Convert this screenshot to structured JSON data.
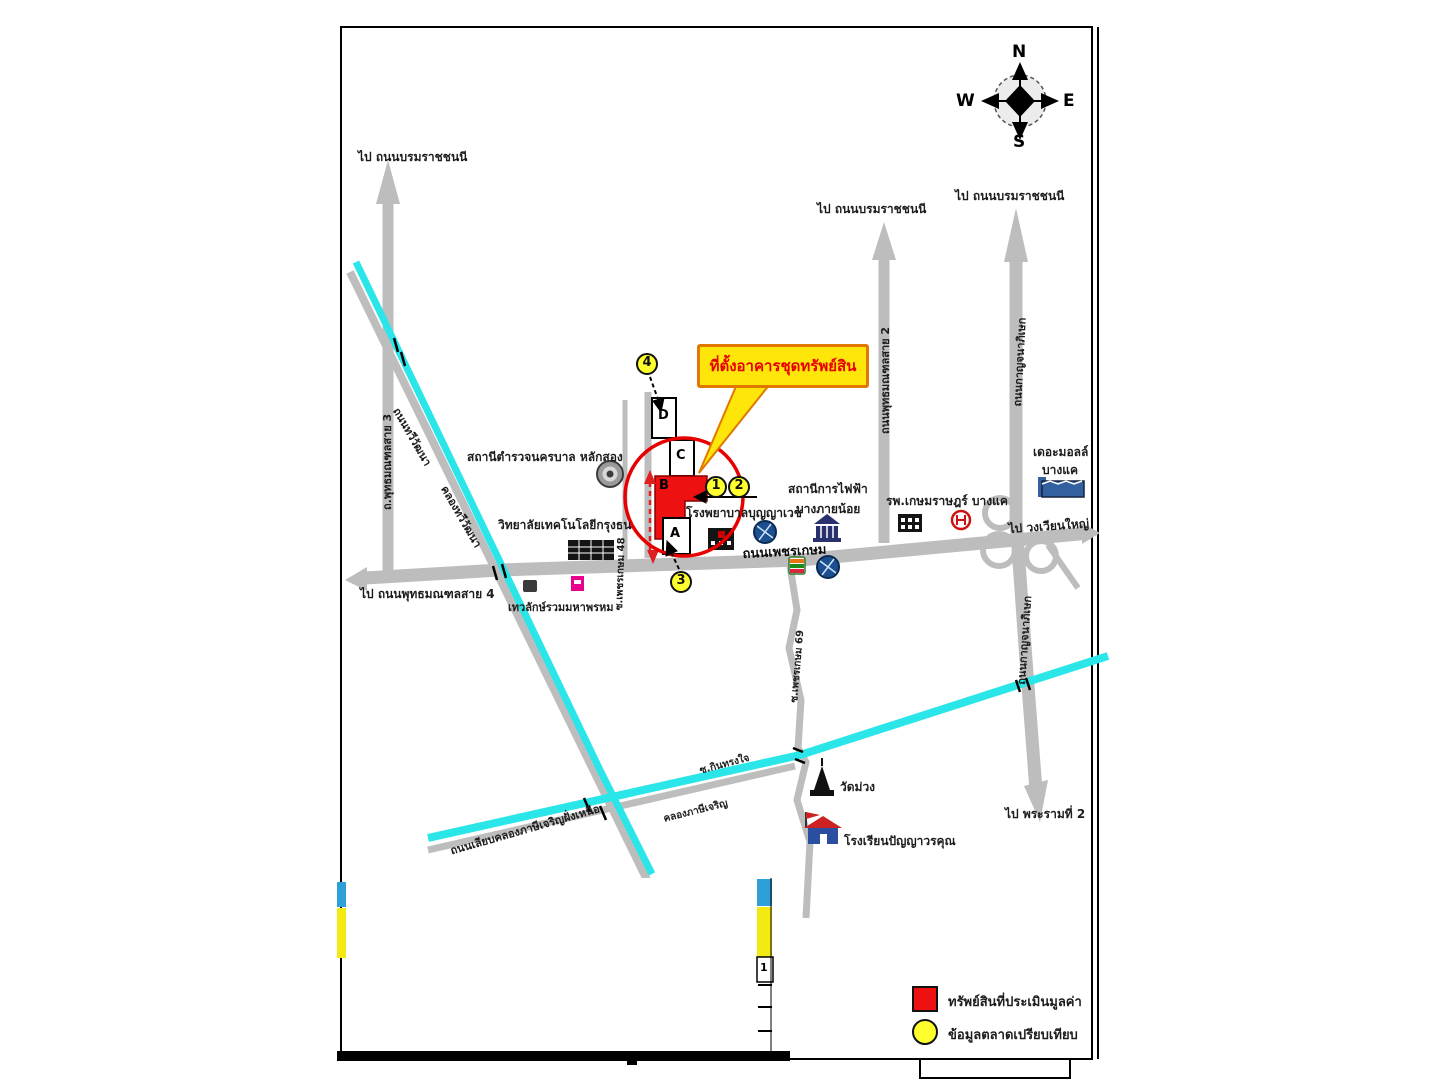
{
  "compass": {
    "n": "N",
    "e": "E",
    "w": "W",
    "s": "S"
  },
  "callout": {
    "text": "ที่ตั้งอาคารชุดทรัพย์สิน"
  },
  "directions": {
    "top_left": "ไป ถนนบรมราชชนนี",
    "sai2_top": "ไป ถนนบรมราชชนนี",
    "kanchana_top": "ไป ถนนบรมราชชนนี",
    "west": "ไป ถนนพุทธมณฑลสาย 4",
    "east": "ไป วงเวียนใหญ่",
    "south": "ไป พระรามที่ 2"
  },
  "roads": {
    "phetkasem": "ถนนเพชรเกษม",
    "sai3": "ถ.พุทธมณฑลสาย 3",
    "sai2": "ถนนพุทธมณฑลสาย 2",
    "kanchanaphisek_north": "ถนนกาญจนาภิเษก",
    "kanchanaphisek_south": "ถนนกาญจนาภิเษก",
    "thawi_watthana_road": "ถนนทวีวัฒนา",
    "soi_phetkasem_69": "ซ.เพชรเกษม 69",
    "soi_phetkasem_48": "ซ.เพชรเกษม 48",
    "soi_kinsongjai": "ซ.กินทรงใจ",
    "liap_khlong": "ถนนเลียบคลองภาษีเจริญฝั่งเหนือ"
  },
  "canals": {
    "thawi_watthana": "คลองทวีวัฒนา",
    "phasi_charoen": "คลองภาษีเจริญ"
  },
  "places": {
    "police": "สถานีตำรวจนครบาล หลักสอง",
    "college": "วิทยาลัยเทคโนโลยีกรุงธน",
    "shrine": "เทวลักษ์รวมมหาพรหม",
    "hospital": "โรงพยาบาลบุญญาเวช",
    "power_station_line1": "สถานีการไฟฟ้า",
    "power_station_line2": "บางภายน้อย",
    "kasemrad": "รพ.เกษมราษฎร์ บางแค",
    "mall_line1": "เดอะมอลล์",
    "mall_line2": "บางแค",
    "wat": "วัดม่วง",
    "school": "โรงเรียนปัญญาวรคุณ"
  },
  "buildings": {
    "a": "A",
    "b": "B",
    "c": "C",
    "d": "D"
  },
  "markers": {
    "m1": "1",
    "m2": "2",
    "m3": "3",
    "m4": "4"
  },
  "legend": {
    "property_label": "ทรัพย์สินที่ประเมินมูลค่า",
    "market_label": "ข้อมูลตลาดเปรียบเทียบ"
  },
  "overlay": {
    "mark": "1"
  },
  "colors": {
    "road_gray": "#bdbdbd",
    "canal_cyan": "#2ae6e8",
    "property_red": "#ee1111",
    "marker_yellow": "#ffff2e",
    "callout_yellow": "#ffe60a",
    "callout_border": "#e07800",
    "annotation_red": "#e80000"
  }
}
